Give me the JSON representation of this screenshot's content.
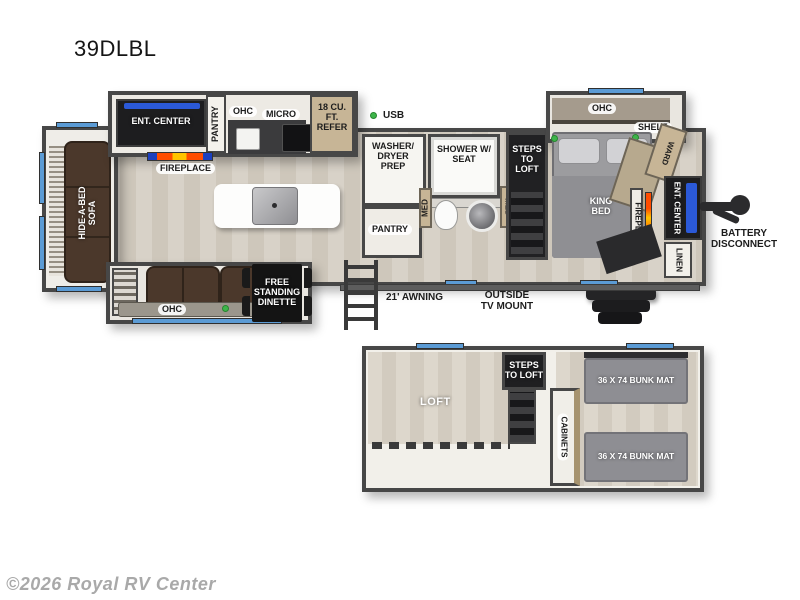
{
  "title": "39DLBL",
  "watermark": "©2026 Royal RV Center",
  "labels": {
    "ent_center_kitchen": "ENT. CENTER",
    "fireplace_kitchen": "FIREPLACE",
    "pantry_kitchen": "PANTRY",
    "ohc_kitchen": "OHC",
    "micro": "MICRO",
    "refer": "18 CU. FT. REFER",
    "usb": "USB",
    "washer_dryer_prep": "WASHER/ DRYER PREP",
    "shower": "SHOWER W/ SEAT",
    "pantry_bath": "PANTRY",
    "med_left": "MED",
    "med_right": "MED",
    "steps_to_loft_main": "STEPS TO LOFT",
    "ohc_bedroom": "OHC",
    "shelf": "SHELF",
    "king_bed": "KING BED",
    "ward": "WARD",
    "fireplace_bedroom": "FIREPLACE",
    "ent_center_bedroom": "ENT. CENTER",
    "linen": "LINEN",
    "battery_disconnect": "BATTERY DISCONNECT",
    "hide_a_bed_sofa": "HIDE-A-BED SOFA",
    "ohc_theater": "OHC",
    "free_standing_dinette": "FREE STANDING DINETTE",
    "awning": "21' AWNING",
    "outside_tv_mount": "OUTSIDE TV MOUNT",
    "loft": "LOFT",
    "steps_to_loft_loft": "STEPS TO LOFT",
    "cabinets": "CABINETS",
    "bunk_mat_top": "36 X 74 BUNK MAT",
    "bunk_mat_bottom": "36 X 74 BUNK MAT"
  },
  "colors": {
    "wall": "#474747",
    "floor_wood": "#d4cdc2",
    "window_blue": "#5b9bd5",
    "led_green": "#3db54a",
    "sofa_brown": "#4b382b",
    "dark_cabinet": "#1d1d1f",
    "tan_cabinet": "#c7b596",
    "bunk_gray": "#8e8e93",
    "tv_blue": "#2b59d8",
    "flame_orange": "#ff6a00"
  }
}
